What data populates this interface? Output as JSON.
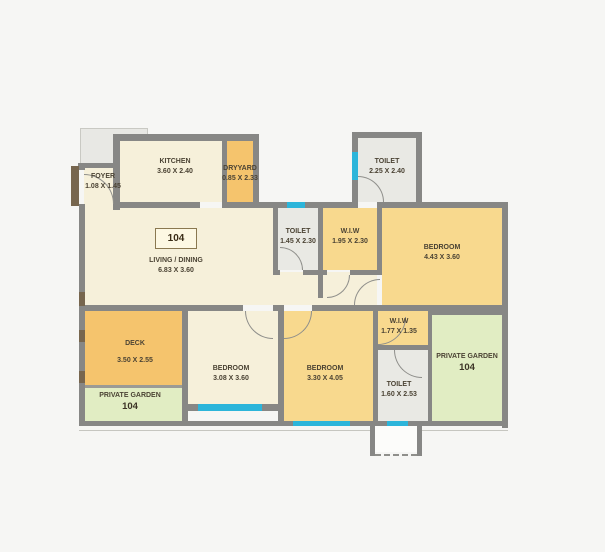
{
  "unit": {
    "number": "104"
  },
  "rooms": {
    "foyer": {
      "name": "FOYER",
      "dims": "1.08 X 1.45"
    },
    "kitchen": {
      "name": "KITCHEN",
      "dims": "3.60 X 2.40"
    },
    "dryyard": {
      "name": "DRYYARD",
      "dims": "0.85 X 2.33"
    },
    "toilet_top": {
      "name": "TOILET",
      "dims": "2.25 X 2.40"
    },
    "living": {
      "name": "LIVING / DINING",
      "dims": "6.83 X 3.60"
    },
    "toilet_mid": {
      "name": "TOILET",
      "dims": "1.45 X 2.30"
    },
    "wiw_mid": {
      "name": "W.I.W",
      "dims": "1.95 X 2.30"
    },
    "bedroom_right": {
      "name": "BEDROOM",
      "dims": "4.43 X 3.60"
    },
    "deck": {
      "name": "DECK",
      "dims": "3.50 X 2.55"
    },
    "garden_left": {
      "name": "PRIVATE GARDEN",
      "unit": "104"
    },
    "bedroom_bottom_left": {
      "name": "BEDROOM",
      "dims": "3.08 X 3.60"
    },
    "bedroom_bottom_mid": {
      "name": "BEDROOM",
      "dims": "3.30 X 4.05"
    },
    "wiw_small": {
      "name": "W.I.W",
      "dims": "1.77 X 1.35"
    },
    "toilet_bottom": {
      "name": "TOILET",
      "dims": "1.60 X 2.53"
    },
    "garden_right": {
      "name": "PRIVATE GARDEN",
      "unit": "104"
    }
  },
  "colors": {
    "wall": "#878785",
    "window": "#2cb5da",
    "door_jamb": "#77664e",
    "floor_cream": "#f6f0da",
    "floor_yellow": "#f8d98e",
    "floor_orange": "#f5c46d",
    "floor_green": "#e1edc3",
    "floor_toilet": "#e9e9e4"
  }
}
